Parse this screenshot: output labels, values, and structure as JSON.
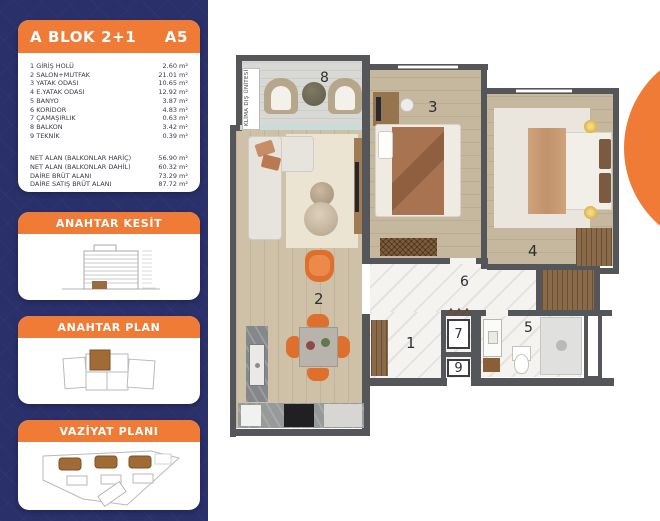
{
  "colors": {
    "navy": "#2a3069",
    "orange": "#ef7b37",
    "wall": "#55565a"
  },
  "sidebar": {
    "info_card": {
      "title": "A BLOK 2+1",
      "unit_code": "A5",
      "rooms": [
        {
          "no": "1",
          "label": "GİRİŞ HOLÜ",
          "area": "2.60 m²"
        },
        {
          "no": "2",
          "label": "SALON+MUTFAK",
          "area": "21.01 m²"
        },
        {
          "no": "3",
          "label": "YATAK ODASI",
          "area": "10.65 m²"
        },
        {
          "no": "4",
          "label": "E.YATAK ODASI",
          "area": "12.92 m²"
        },
        {
          "no": "5",
          "label": "BANYO",
          "area": "3.87 m²"
        },
        {
          "no": "6",
          "label": "KORİDOR",
          "area": "4.83 m²"
        },
        {
          "no": "7",
          "label": "ÇAMAŞIRLIK",
          "area": "0.63 m²"
        },
        {
          "no": "8",
          "label": "BALKON",
          "area": "3.42 m²"
        },
        {
          "no": "9",
          "label": "TEKNİK",
          "area": "0.39 m²"
        }
      ],
      "summary": [
        {
          "label": "NET ALAN (BALKONLAR HARİÇ)",
          "value": "56.90 m²"
        },
        {
          "label": "NET ALAN (BALKONLAR DAHİL)",
          "value": "60.32 m²"
        },
        {
          "label": "DAİRE BRÜT ALANI",
          "value": "73.29 m²"
        },
        {
          "label": "DAİRE SATIŞ BRÜT ALANI",
          "value": "87.72 m²"
        }
      ]
    },
    "section_card": {
      "title": "ANAHTAR KESİT"
    },
    "key_plan_card": {
      "title": "ANAHTAR PLAN"
    },
    "site_plan_card": {
      "title": "VAZİYAT PLANI"
    }
  },
  "floorplan": {
    "klima_label": "KLİMA DIŞ ÜNİTESİ",
    "labels": {
      "n1": "1",
      "n2": "2",
      "n3": "3",
      "n4": "4",
      "n5": "5",
      "n6": "6",
      "n7": "7",
      "n8": "8",
      "n9": "9"
    }
  }
}
